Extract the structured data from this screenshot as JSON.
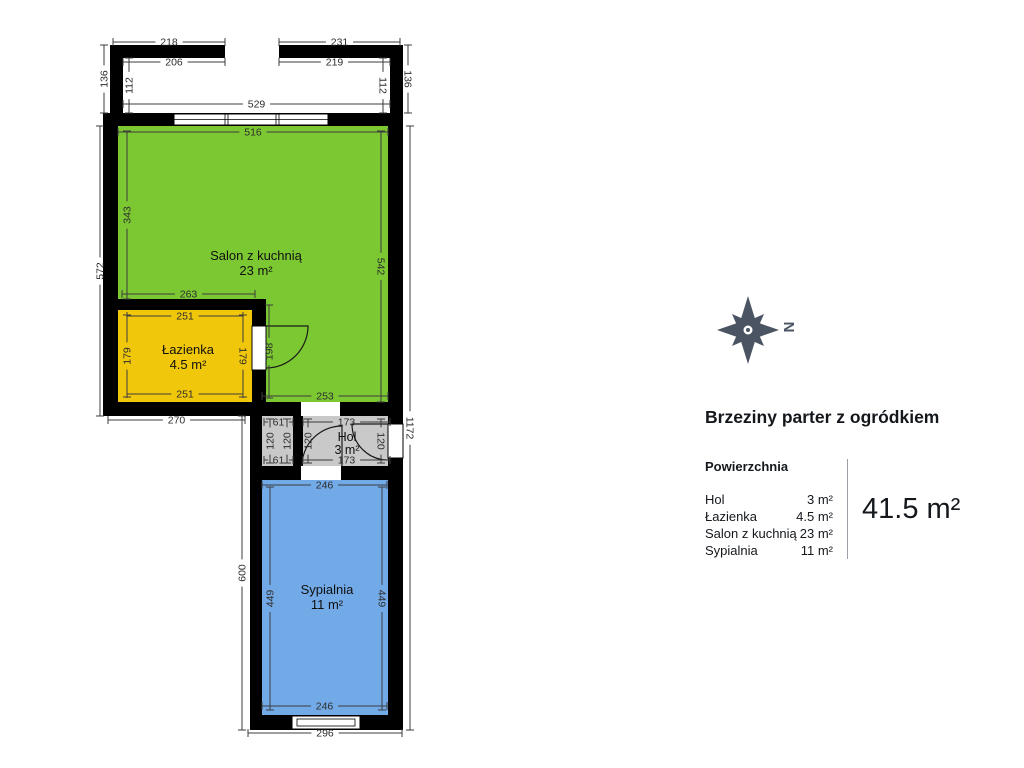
{
  "title": "Brzeziny parter z ogródkiem",
  "legend": {
    "heading": "Powierzchnia",
    "rows": [
      {
        "name": "Hol",
        "area": "3 m²"
      },
      {
        "name": "Łazienka",
        "area": "4.5 m²"
      },
      {
        "name": "Salon z kuchnią",
        "area": "23 m²"
      },
      {
        "name": "Sypialnia",
        "area": "11 m²"
      }
    ],
    "total": "41.5 m²"
  },
  "compass": {
    "north": "N"
  },
  "rooms": [
    {
      "name": "Salon z kuchnią",
      "area": "23 m²"
    },
    {
      "name": "Łazienka",
      "area": "4.5 m²"
    },
    {
      "name": "Hol",
      "area": "3 m²"
    },
    {
      "name": "Sypialnia",
      "area": "11 m²"
    }
  ],
  "colors": {
    "salon": "#7cc832",
    "lazienka": "#f0c70a",
    "hol": "#c9c9c9",
    "sypialnia": "#72a9e7",
    "wall": "#000000",
    "compass": "#4a5462"
  },
  "dims": [
    {
      "v": "218"
    },
    {
      "v": "231"
    },
    {
      "v": "206"
    },
    {
      "v": "219"
    },
    {
      "v": "136"
    },
    {
      "v": "112"
    },
    {
      "v": "112"
    },
    {
      "v": "136"
    },
    {
      "v": "529"
    },
    {
      "v": "516"
    },
    {
      "v": "343"
    },
    {
      "v": "572"
    },
    {
      "v": "542"
    },
    {
      "v": "263"
    },
    {
      "v": "251"
    },
    {
      "v": "179"
    },
    {
      "v": "179"
    },
    {
      "v": "251"
    },
    {
      "v": "198"
    },
    {
      "v": "253"
    },
    {
      "v": "270"
    },
    {
      "v": "61"
    },
    {
      "v": "120"
    },
    {
      "v": "120"
    },
    {
      "v": "61"
    },
    {
      "v": "173"
    },
    {
      "v": "120"
    },
    {
      "v": "120"
    },
    {
      "v": "173"
    },
    {
      "v": "1172"
    },
    {
      "v": "246"
    },
    {
      "v": "449"
    },
    {
      "v": "449"
    },
    {
      "v": "246"
    },
    {
      "v": "600"
    },
    {
      "v": "296"
    }
  ]
}
